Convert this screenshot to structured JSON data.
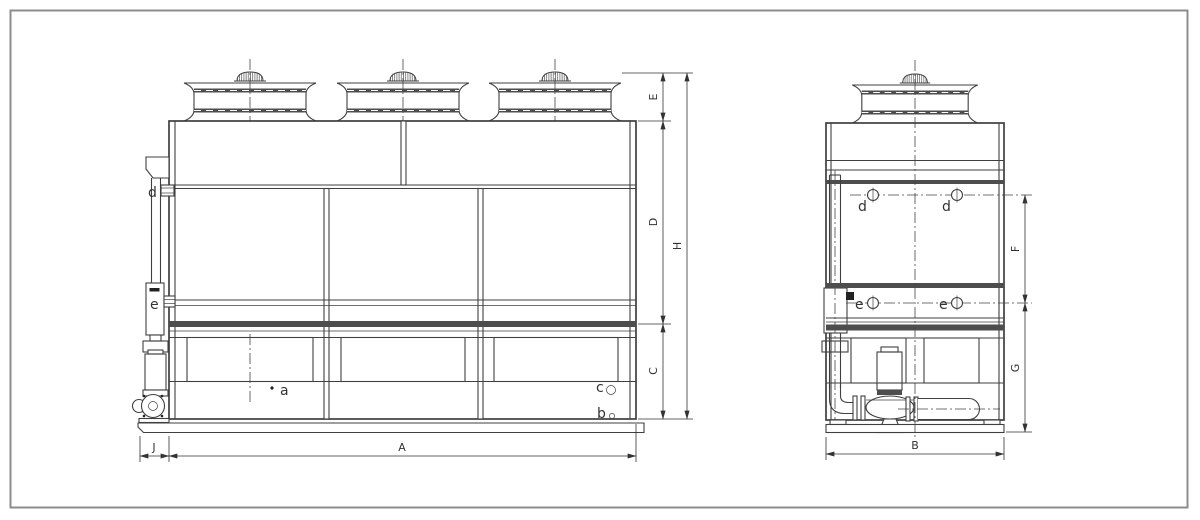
{
  "drawing": {
    "dims": {
      "A": "A",
      "B": "B",
      "C": "C",
      "D": "D",
      "E": "E",
      "F": "F",
      "G": "G",
      "H": "H",
      "J": "J"
    },
    "ports": {
      "a": "a",
      "b": "b",
      "c": "c",
      "d": "d",
      "e": "e"
    },
    "colors": {
      "line": "#3f3f3f",
      "band": "#4d4d4d",
      "dimension": "#333333",
      "background": "#ffffff",
      "frame": "#8c8c8c"
    }
  }
}
